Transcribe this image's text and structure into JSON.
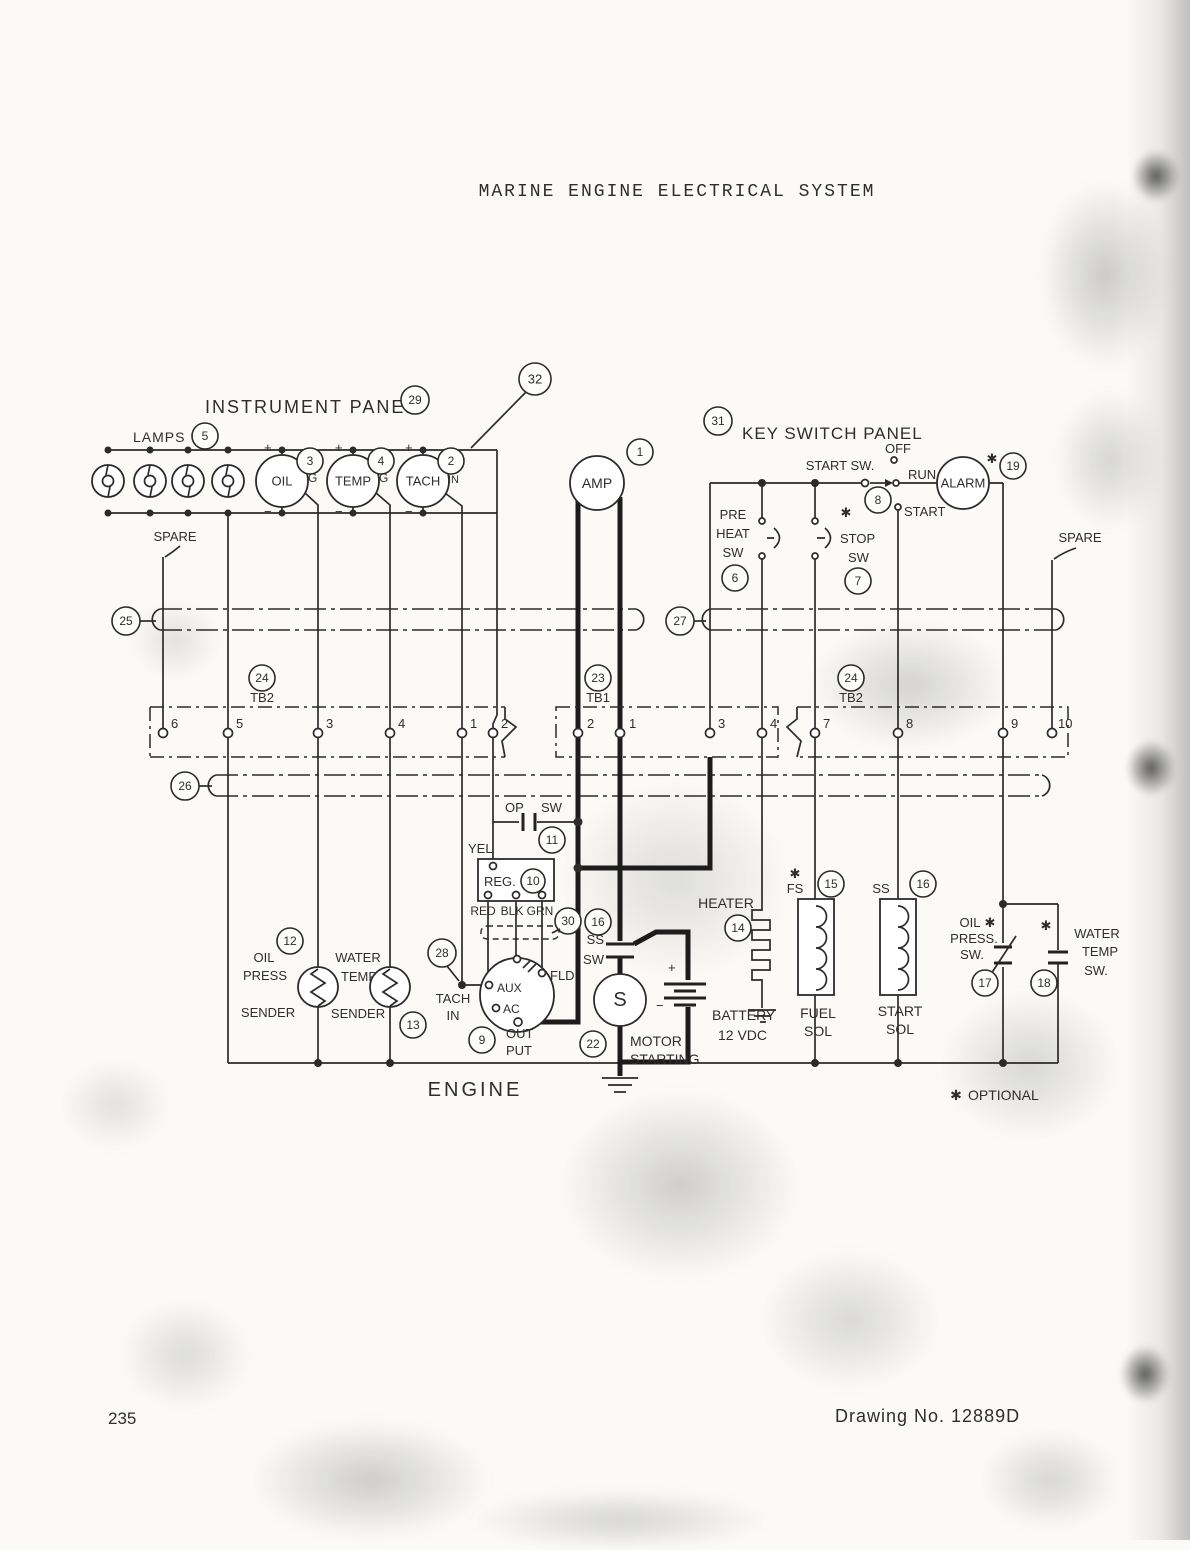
{
  "colors": {
    "ink": "#2b2b2b",
    "paper": "#fbfaf6"
  },
  "page": {
    "title": "MARINE ENGINE ELECTRICAL SYSTEM",
    "page_number": "235",
    "drawing_no": "Drawing No. 12889D",
    "optional_note": "OPTIONAL",
    "star_marker": "✱",
    "engine_label": "ENGINE"
  },
  "panels": {
    "instrument": {
      "label": "INSTRUMENT PANEL",
      "callout": "29",
      "enclosure_callout": "32",
      "lamps_label": "LAMPS",
      "lamps_callout": "5",
      "spare_label": "SPARE"
    },
    "key_switch": {
      "label": "KEY SWITCH PANEL",
      "callout": "31",
      "start_sw_label": "START SW.",
      "off": "OFF",
      "run": "RUN",
      "start": "START",
      "start_sw_callout": "8",
      "spare_label": "SPARE"
    }
  },
  "gauges": {
    "plus": "+",
    "minus": "−",
    "oil": {
      "label": "OIL",
      "callout": "3",
      "terminal": "G"
    },
    "temp": {
      "label": "TEMP",
      "callout": "4",
      "terminal": "G"
    },
    "tach": {
      "label": "TACH",
      "callout": "2",
      "terminal": "IN"
    },
    "amp": {
      "label": "AMP",
      "callout": "1"
    }
  },
  "switches": {
    "pre_heat": {
      "lines": [
        "PRE",
        "HEAT",
        "SW"
      ],
      "callout": "6"
    },
    "stop": {
      "lines": [
        "STOP",
        "SW"
      ],
      "callout": "7"
    },
    "op": {
      "op": "OP",
      "sw": "SW",
      "callout": "11"
    },
    "ss": {
      "ss": "SS",
      "sw": "SW",
      "callout": "16"
    },
    "oil_press": {
      "lines": [
        "OIL",
        "PRESS.",
        "SW."
      ],
      "callout": "17"
    },
    "water_temp": {
      "lines": [
        "WATER",
        "TEMP",
        "SW."
      ],
      "callout": "18"
    }
  },
  "alarm": {
    "label": "ALARM",
    "callout": "19"
  },
  "regulator": {
    "label": "REG.",
    "callout": "10",
    "wire_yel": "YEL",
    "wires": [
      "RED",
      "BLK",
      "GRN"
    ],
    "connector_callout": "30"
  },
  "alternator": {
    "aux": "AUX",
    "ac": "AC",
    "fld": "FLD",
    "output_lines": [
      "OUT",
      "PUT"
    ],
    "output_callout": "9",
    "tach_in_lines": [
      "TACH",
      "IN"
    ],
    "tach_in_callout": "28"
  },
  "starter": {
    "label": "S",
    "motor_lines": [
      "MOTOR",
      "STARTING"
    ],
    "callout": "22",
    "battery_lines": [
      "BATTERY",
      "12 VDC"
    ]
  },
  "heater": {
    "label": "HEATER",
    "callout": "14"
  },
  "solenoids": {
    "fuel": {
      "tag": "FS",
      "callout": "15",
      "lines": [
        "FUEL",
        "SOL"
      ]
    },
    "start": {
      "tag": "SS",
      "callout": "16",
      "lines": [
        "START",
        "SOL"
      ]
    }
  },
  "senders": {
    "oil": {
      "lines": [
        "OIL",
        "PRESS",
        "SENDER"
      ],
      "callout": "12"
    },
    "water": {
      "lines": [
        "WATER",
        "TEMP",
        "SENDER"
      ],
      "callout": "13"
    }
  },
  "terminal_blocks": {
    "tb2_left": {
      "name": "TB2",
      "callout": "24",
      "terminals": [
        "6",
        "5",
        "3",
        "4",
        "1",
        "2"
      ]
    },
    "tb1": {
      "name": "TB1",
      "callout": "23",
      "terminals": [
        "2",
        "1",
        "3",
        "4"
      ]
    },
    "tb2_right": {
      "name": "TB2",
      "callout": "24",
      "terminals": [
        "7",
        "8",
        "9",
        "10"
      ]
    }
  },
  "harnesses": {
    "h25": "25",
    "h26": "26",
    "h27": "27"
  }
}
